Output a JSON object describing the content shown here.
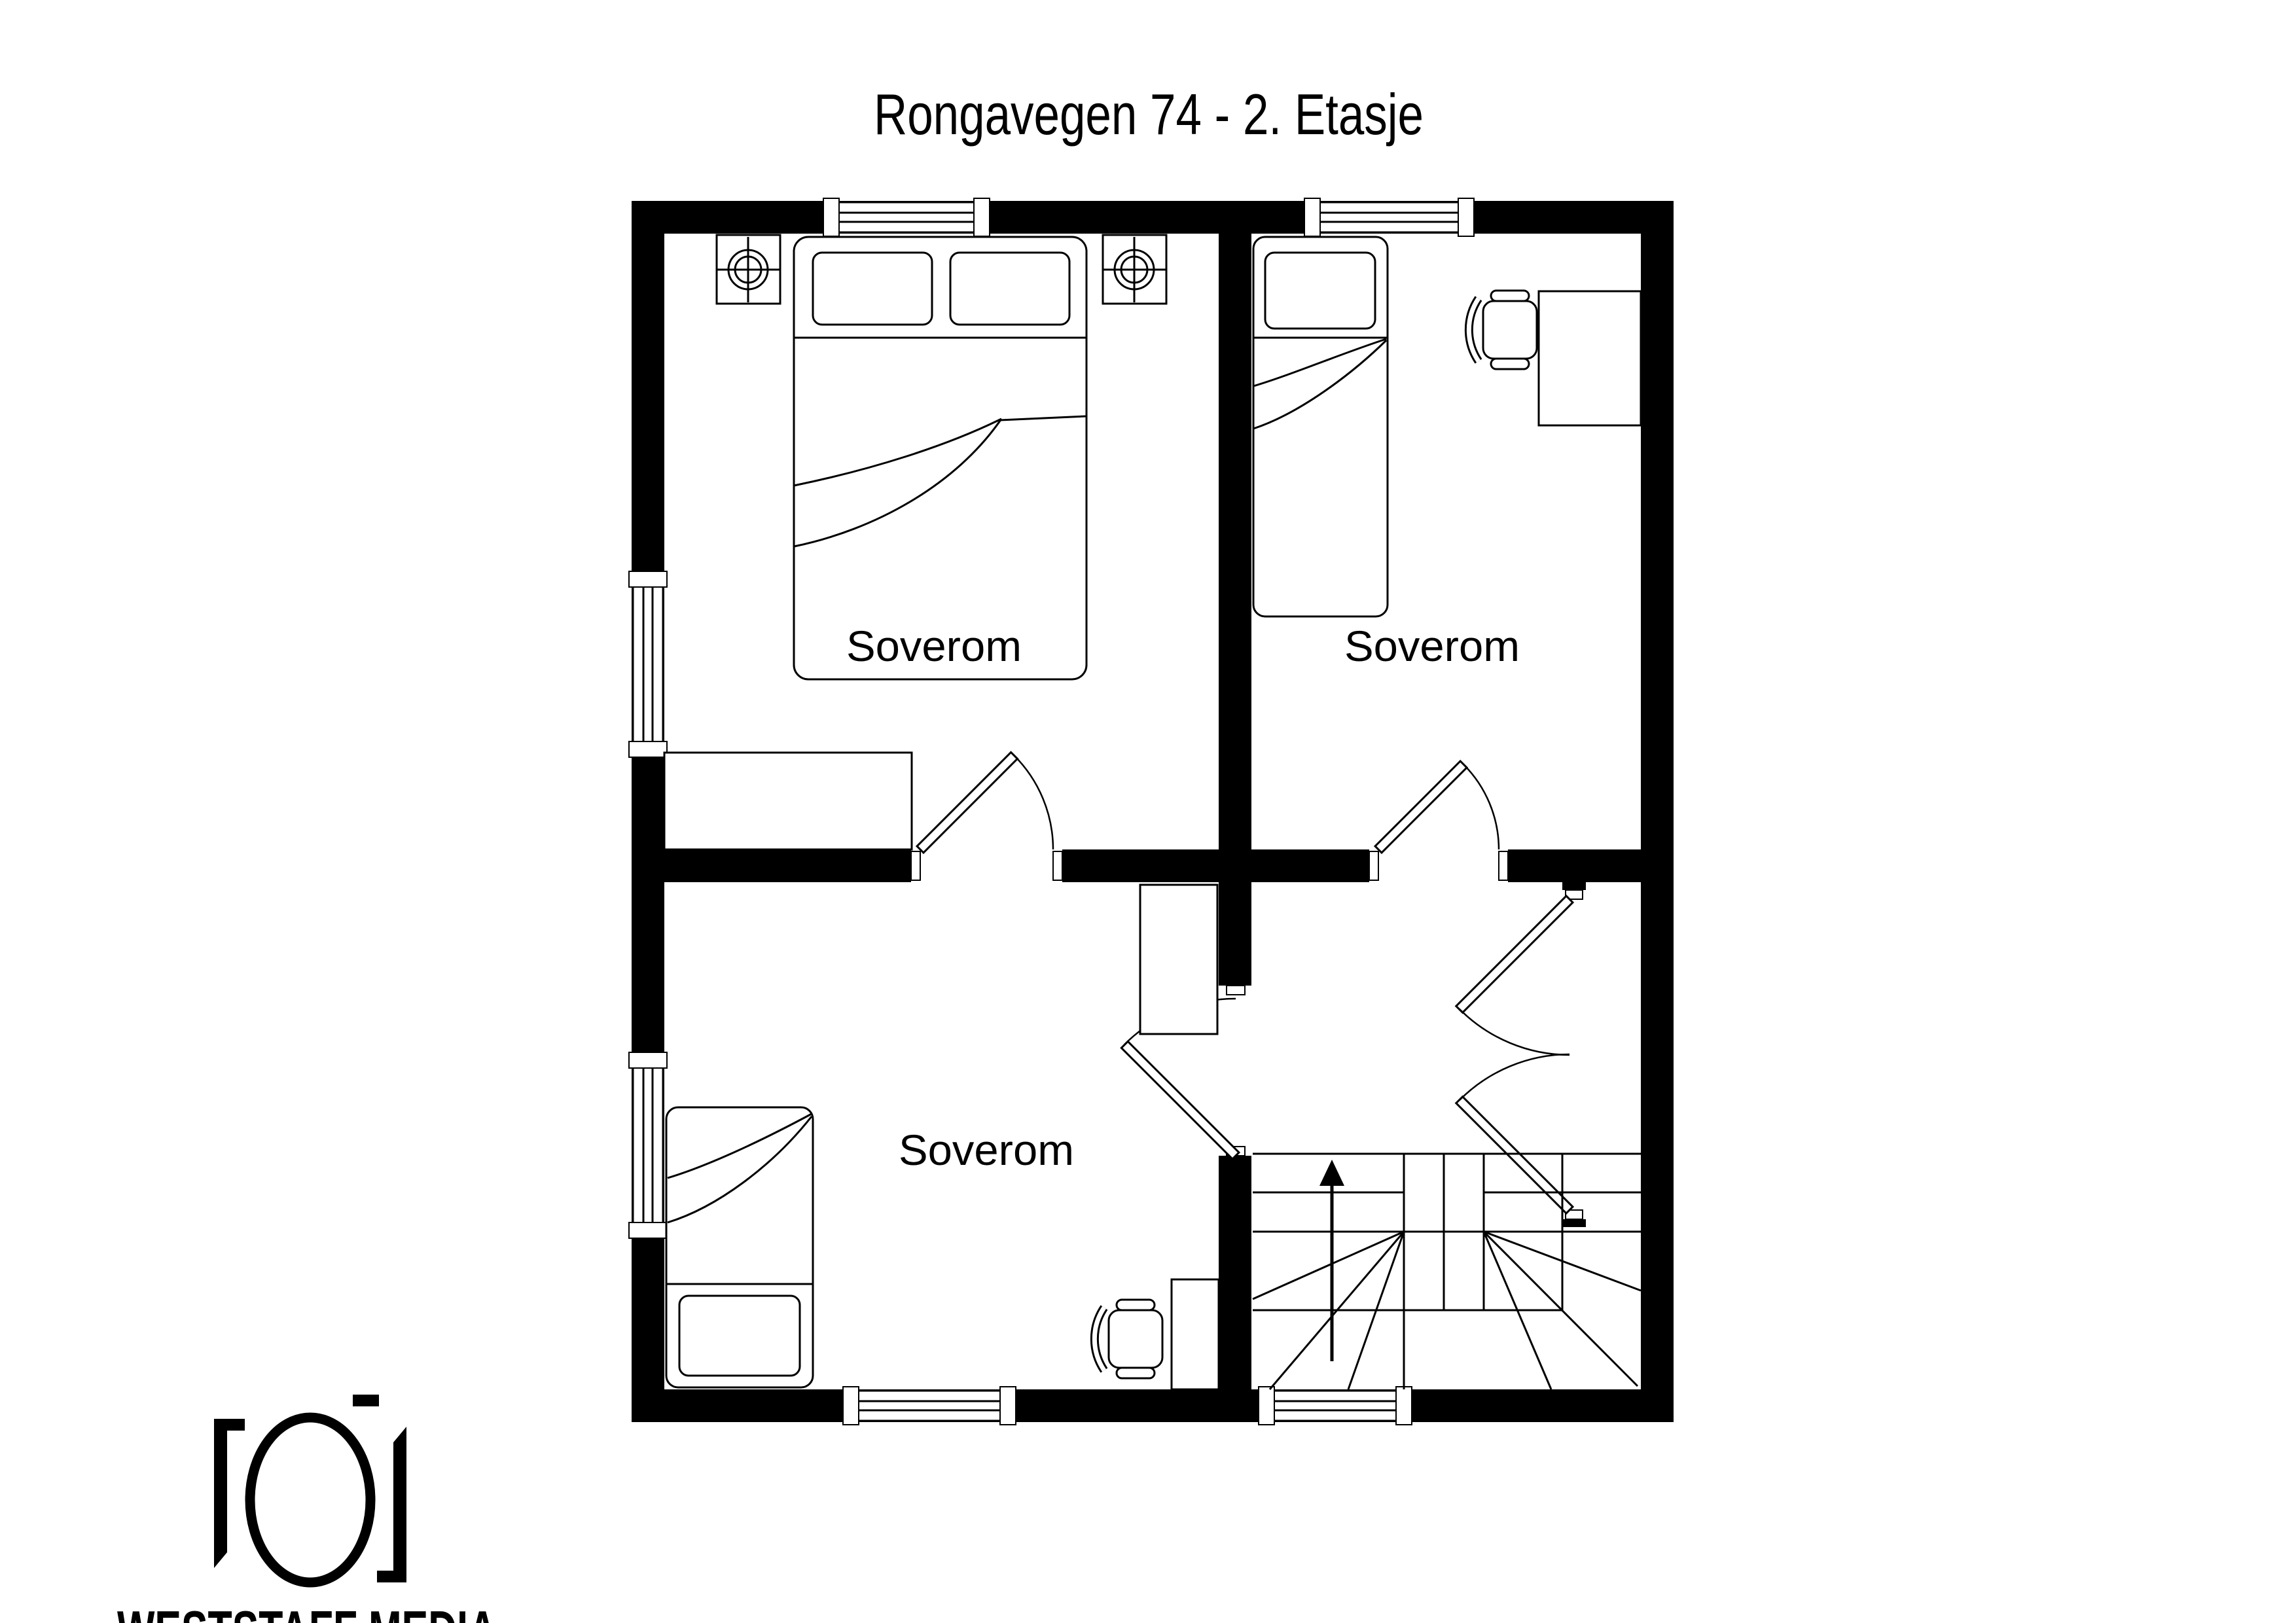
{
  "title": "Rongavegen 74 - 2. Etasje",
  "rooms": [
    {
      "id": "bedroom-top-left",
      "label": "Soverom"
    },
    {
      "id": "bedroom-top-right",
      "label": "Soverom"
    },
    {
      "id": "bedroom-bottom-left",
      "label": "Soverom"
    }
  ],
  "stairs": {
    "direction_arrow": "up"
  },
  "logo": {
    "name": "WESTSTAFF MEDIA",
    "icon": "camera-icon"
  },
  "colors": {
    "walls": "#000000",
    "background": "#ffffff",
    "lines": "#000000"
  }
}
